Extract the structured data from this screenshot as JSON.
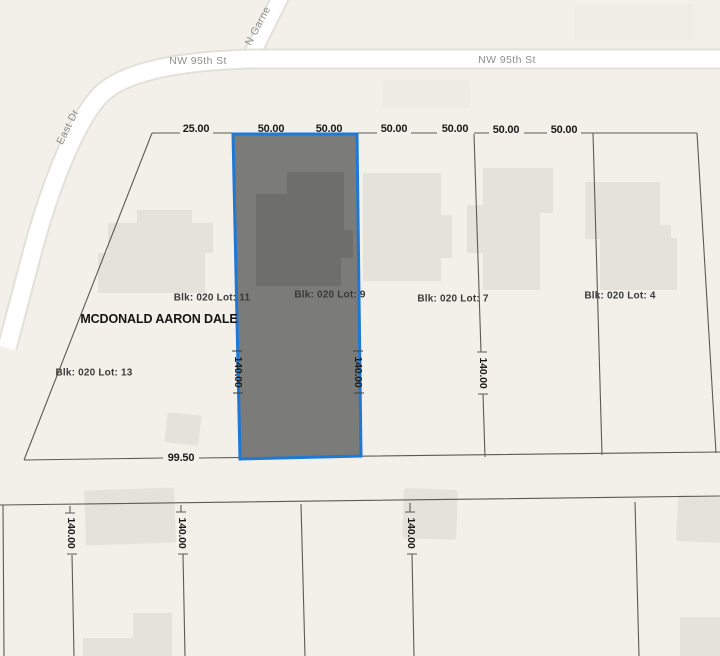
{
  "colors": {
    "background": "#f2f0e9",
    "road": "#ffffff",
    "road_casing": "#e2e0d8",
    "building": "#e4e2db",
    "parcel_fill": "#7b7b79",
    "parcel_building": "#6e6e6c",
    "parcel_border": "#1e78d6",
    "boundary_line": "#5b5a54",
    "street_label": "#8e8e8a",
    "lot_label": "#3a3a3a",
    "dimension_label": "#1b1b1b"
  },
  "streets": {
    "nw_95th_left": "NW 95th St",
    "nw_95th_right": "NW 95th St",
    "n_garnett": "N Garne",
    "east_dr": "East Dr"
  },
  "owner_name": "MCDONALD AARON DALE",
  "lot_labels": {
    "lot_11": "Blk: 020 Lot: 11",
    "lot_9": "Blk: 020 Lot: 9",
    "lot_7": "Blk: 020 Lot: 7",
    "lot_4": "Blk: 020 Lot: 4",
    "lot_13": "Blk: 020 Lot: 13"
  },
  "dimensions": {
    "top": [
      "25.00",
      "50.00",
      "50.00",
      "50.00",
      "50.00",
      "50.00",
      "50.00"
    ],
    "parcel_left_depth": "140.00",
    "parcel_right_depth": "140.00",
    "lot7_depth": "140.00",
    "bottom_width": "99.50",
    "south_block_depths": [
      "140.00",
      "140.00",
      "140.00"
    ]
  }
}
